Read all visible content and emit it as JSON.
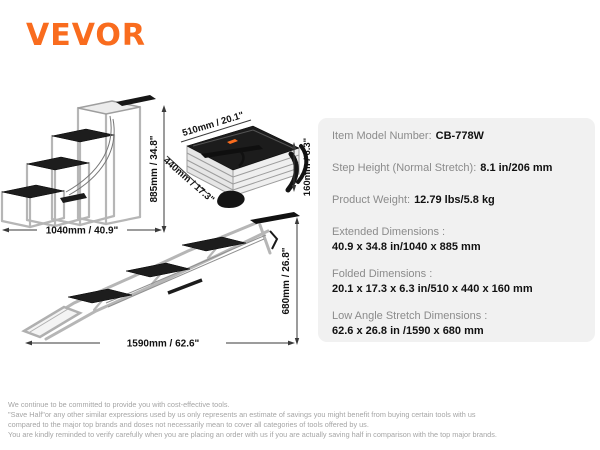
{
  "brand": {
    "name": "VEVOR",
    "color": "#F96C1E"
  },
  "diagrams": {
    "extended": {
      "height_label": "885mm / 34.8\"",
      "width_label": "1040mm / 40.9\""
    },
    "folded": {
      "length_label": "510mm / 20.1\"",
      "depth_label": "440mm / 17.3\"",
      "height_label": "160mm / 6.3\""
    },
    "low_angle": {
      "width_label": "1590mm / 62.6\"",
      "height_label": "680mm / 26.8\""
    }
  },
  "specs": {
    "bg_color": "#f1f1f1",
    "rows": [
      {
        "label": "Item Model Number:",
        "value": "CB-778W"
      },
      {
        "label": "Step Height (Normal Stretch):",
        "value": "8.1 in/206 mm"
      },
      {
        "label": "Product Weight:",
        "value": "12.79 lbs/5.8 kg"
      },
      {
        "label": "Extended Dimensions :",
        "value": "40.9 x 34.8 in/1040 x 885 mm"
      },
      {
        "label": "Folded Dimensions :",
        "value": "20.1 x 17.3 x 6.3 in/510 x 440 x 160 mm"
      },
      {
        "label": "Low Angle Stretch Dimensions :",
        "value": "62.6 x 26.8 in /1590 x 680 mm"
      }
    ]
  },
  "footer": {
    "lines": [
      "We continue to be committed to provide you with cost-effective tools.",
      "\"Save Half\"or any other similar expressions used by us only represents an estimate of savings you might benefit from buying certain tools with us",
      "compared to the major top brands and doses not necessarily mean to cover all categories of tools offered by us.",
      "You are kindly reminded to verify carefully when you are placing an order with us if you are actually saving half in comparison with the top major brands."
    ]
  }
}
